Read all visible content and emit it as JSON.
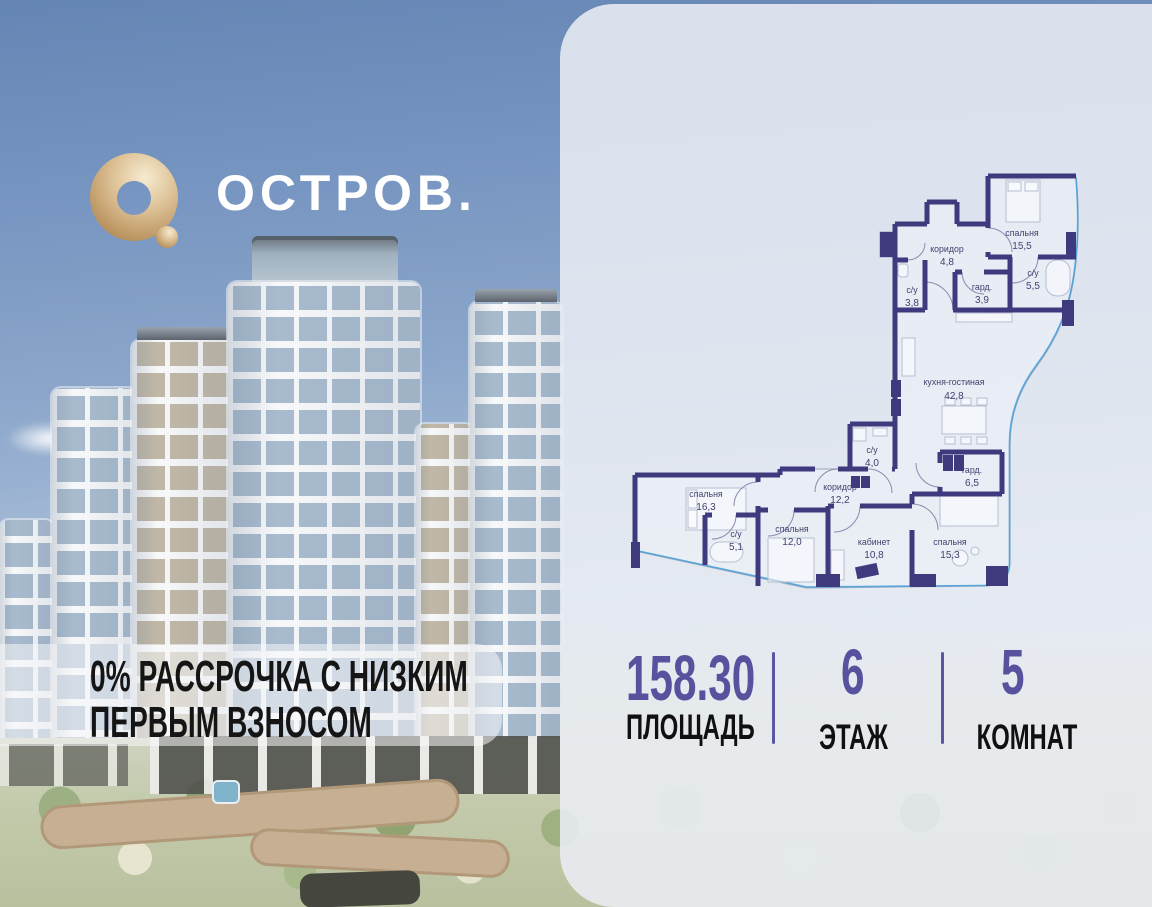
{
  "brand": {
    "name": "ОСТРОВ."
  },
  "promo": {
    "line1": "0% РАССРОЧКА С НИЗКИМ",
    "line2": "ПЕРВЫМ ВЗНОСОМ"
  },
  "stats": [
    {
      "value": "158.30",
      "label": "ПЛОЩАДЬ"
    },
    {
      "value": "6",
      "label": "ЭТАЖ"
    },
    {
      "value": "5",
      "label": "КОМНАТ"
    }
  ],
  "plan": {
    "rooms": [
      {
        "name": "спальня",
        "area": "15,5"
      },
      {
        "name": "коридор",
        "area": "4,8"
      },
      {
        "name": "с/у",
        "area": "3,8"
      },
      {
        "name": "гард.",
        "area": "3,9"
      },
      {
        "name": "с/у",
        "area": "5,5"
      },
      {
        "name": "кухня-гостиная",
        "area": "42,8"
      },
      {
        "name": "с/у",
        "area": "4,0"
      },
      {
        "name": "коридор",
        "area": "12,2"
      },
      {
        "name": "гард.",
        "area": "6,5"
      },
      {
        "name": "спальня",
        "area": "16,3"
      },
      {
        "name": "с/у",
        "area": "5,1"
      },
      {
        "name": "спальня",
        "area": "12,0"
      },
      {
        "name": "кабинет",
        "area": "10,8"
      },
      {
        "name": "спальня",
        "area": "15,3"
      }
    ]
  },
  "colors": {
    "accent_purple": "#57519e",
    "wall_purple": "#3f3a7e",
    "glazing_blue": "#4aa0d6",
    "logo_gold": "#d9bc8e",
    "panel_bg": "#e9edf4"
  }
}
